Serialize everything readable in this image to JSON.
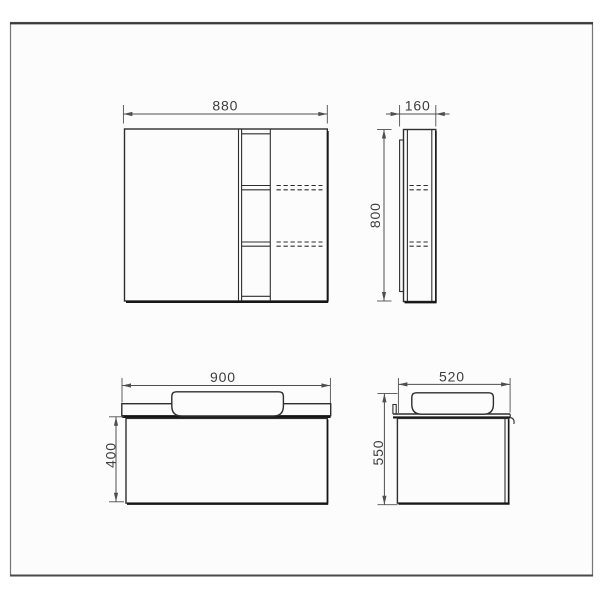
{
  "colors": {
    "background": "#ffffff",
    "paper": "#fcfcfc",
    "frame": "#767676",
    "frame_top": "#3a3a3a",
    "line": "#2e2e2e",
    "line_heavy": "#161616",
    "dim": "#4f4f4f",
    "text": "#3d3d3d"
  },
  "views": {
    "mirror_front": {
      "dims": {
        "width": "880"
      }
    },
    "mirror_side": {
      "dims": {
        "depth": "160",
        "height": "800"
      }
    },
    "vanity_front": {
      "dims": {
        "width": "900",
        "height": "400"
      }
    },
    "vanity_side": {
      "dims": {
        "depth": "520",
        "height": "550"
      }
    }
  }
}
